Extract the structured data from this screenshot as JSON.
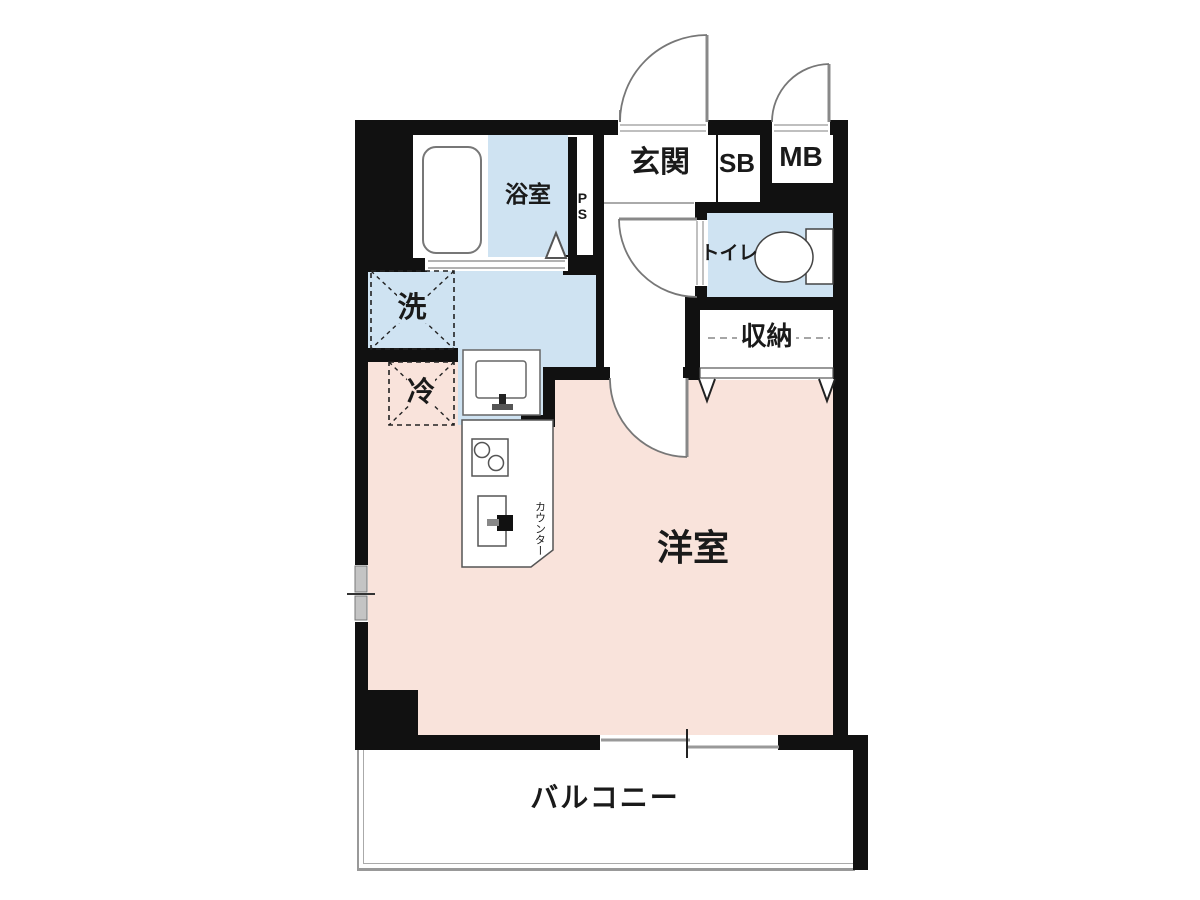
{
  "colors": {
    "wall": "#111111",
    "room_pink": "#f9e3db",
    "wet_blue": "#cfe3f2",
    "outline": "#555555"
  },
  "rooms": {
    "bathroom": {
      "label": "浴室"
    },
    "pipe_shaft": {
      "label": "PS"
    },
    "entrance": {
      "label": "玄関"
    },
    "shoe_box": {
      "label": "SB"
    },
    "meter_box": {
      "label": "MB"
    },
    "toilet": {
      "label": "トイレ"
    },
    "storage": {
      "label": "収納"
    },
    "washing_machine": {
      "label": "洗"
    },
    "refrigerator": {
      "label": "冷"
    },
    "western_room": {
      "label": "洋室"
    },
    "kitchen_counter": {
      "label": "カウンター"
    },
    "balcony": {
      "label": "バルコニー"
    }
  }
}
